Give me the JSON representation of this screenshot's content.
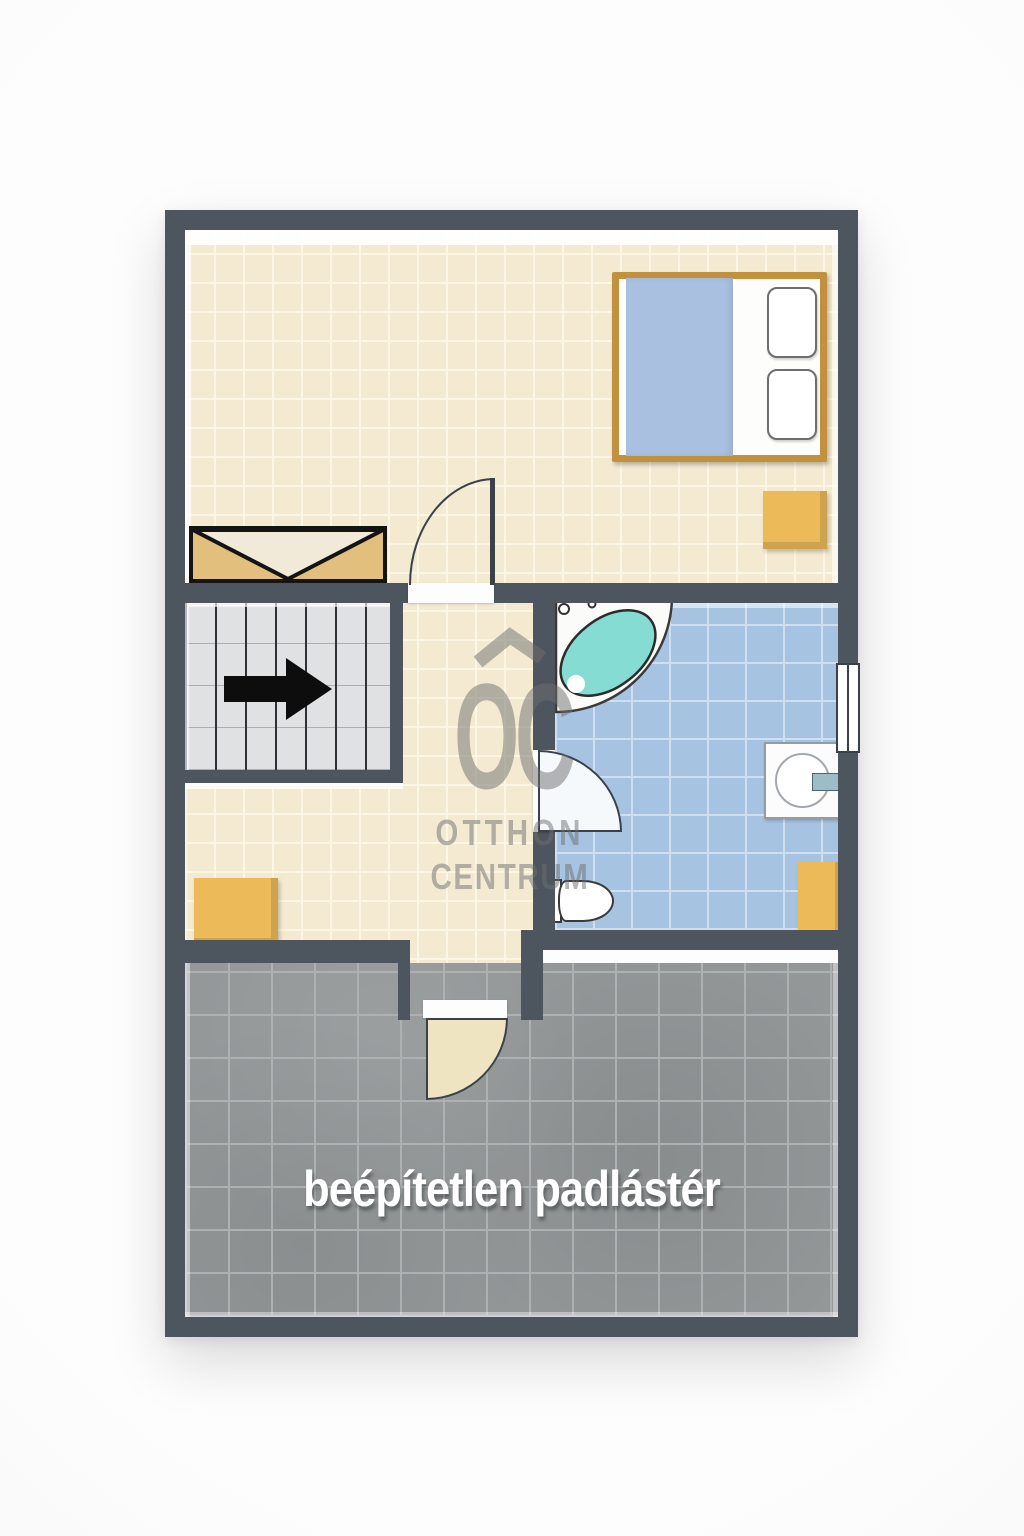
{
  "watermark": {
    "logo_text": "OC",
    "line1": "OTTHON",
    "line2": "CENTRUM",
    "roof_icon": "roof-chevron-icon"
  },
  "attic": {
    "label": "beépítetlen padlástér"
  },
  "fixtures": {
    "bed": "double-bed",
    "pillow_count": 2,
    "nightstand": "nightstand",
    "wardrobe": "wardrobe-with-v-doors",
    "staircase": "staircase",
    "direction_arrow": "right-arrow",
    "bathtub": "corner-bathtub",
    "toilet": "toilet",
    "washbasin": "washbasin-with-faucet",
    "window": "double-pane-window",
    "bathroom_cabinet": "cabinet",
    "landing_cabinet": "cabinet",
    "door_count": 3
  },
  "colors": {
    "wall": "#4D565E",
    "line": "#3A4149",
    "cream": "#F4EAD1",
    "cream_grout": "#FCF6E4",
    "blue": "#A6C3E1",
    "blue_grout": "#CFDFF0",
    "gray": "#939798",
    "gray_grout": "#AEB1B2",
    "stairs_bg": "#E0E1E3",
    "stairs_line": "#2E3236",
    "wood": "#C2913E",
    "blanket": "#A9C0E1",
    "accent": "#ECBA58",
    "teal": "#85DCD3",
    "watermark": "#6F6F6F",
    "label": "#FFFFFF"
  }
}
